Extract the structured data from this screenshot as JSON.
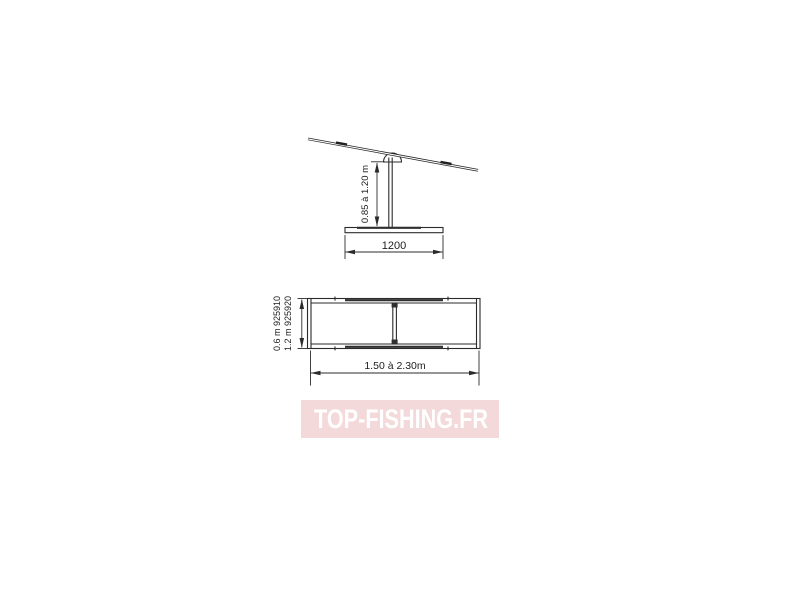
{
  "side_view": {
    "height_dim_label": "0.85 à 1.20 m",
    "base_dim_label": "1200"
  },
  "plan_view": {
    "width_dim_label_line1": "0.6 m 925910",
    "width_dim_label_line2": "1.2 m 925920",
    "length_dim_label": "1.50 à 2.30m"
  },
  "watermark": {
    "label": "TOP-FISHING.FR",
    "band_color": "#f3d9d9",
    "text_color": "#ffffff"
  },
  "style": {
    "line_color": "#2b2b2b",
    "text_color": "#1c1c1c"
  }
}
